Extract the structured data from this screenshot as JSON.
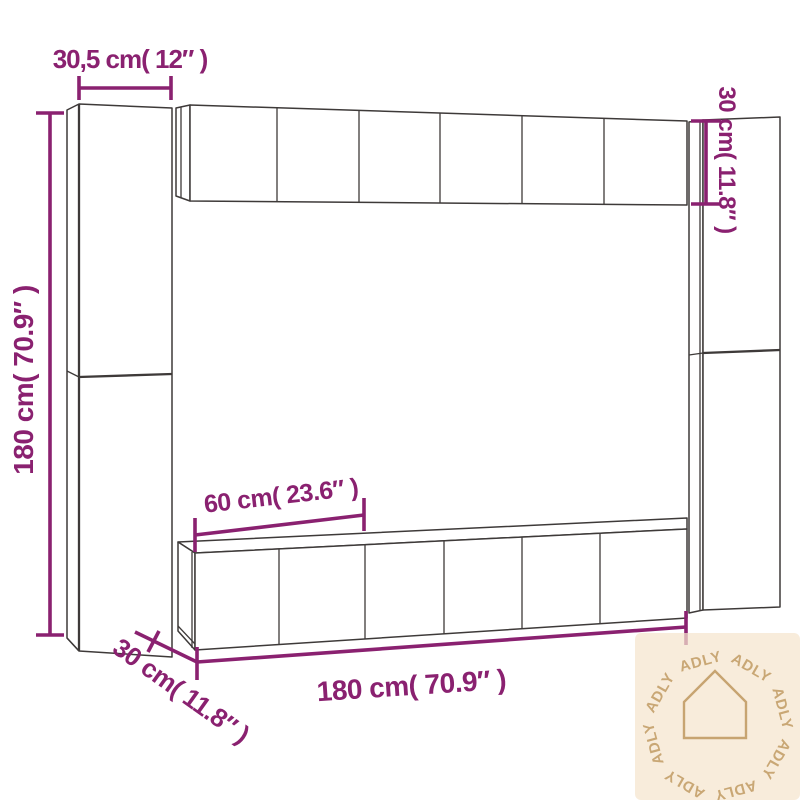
{
  "colors": {
    "background": "#ffffff",
    "structure_line": "#3e3a39",
    "dimension": "#8a2170",
    "watermark_bg": "#f5e5cd",
    "watermark_fg": "#c4a06b"
  },
  "dimensions": {
    "left_unit_width": "30,5 cm( 12″ )",
    "left_unit_height": "180 cm( 70.9″ )",
    "top_row_height": "30 cm( 11.8″ )",
    "bottom_unit_width": "60 cm( 23.6″ )",
    "unit_depth": "30 cm( 11.8″ )",
    "bottom_row_width": "180 cm( 70.9″ )"
  },
  "watermark": {
    "brand": "ADLY",
    "icon": "house-icon"
  }
}
